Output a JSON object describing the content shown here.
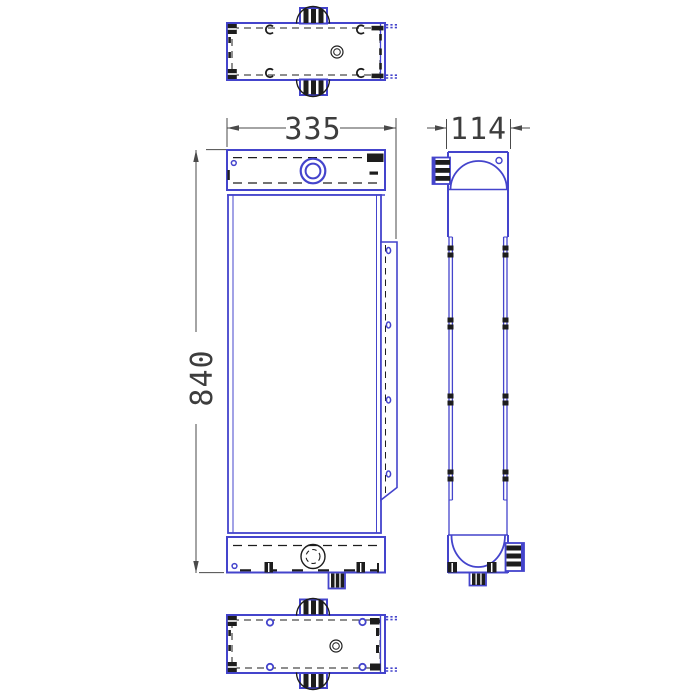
{
  "dimensions": {
    "front_width": "335",
    "side_depth": "114",
    "front_height": "840"
  },
  "colors": {
    "outline_blue": "#4444cc",
    "detail_black": "#1d1d1d",
    "dimension_gray": "#4a4a4a",
    "text_color": "#3d3d3d",
    "background": "#ffffff"
  }
}
